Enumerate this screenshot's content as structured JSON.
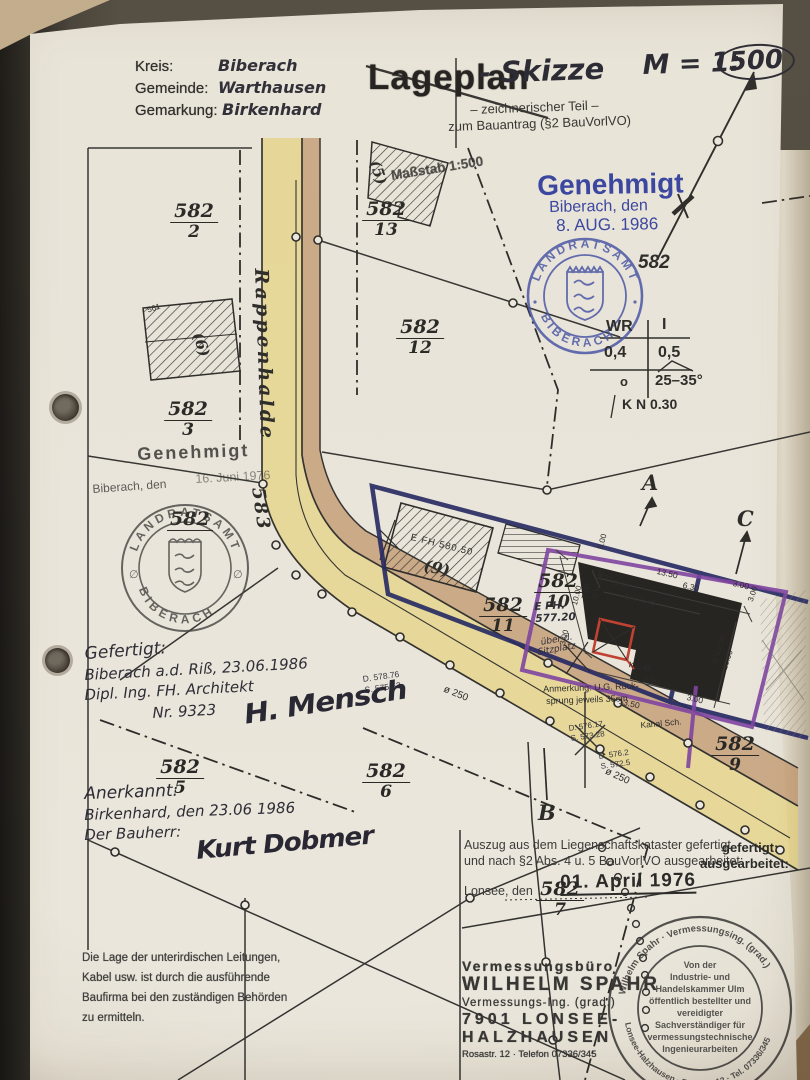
{
  "header": {
    "kreis_label": "Kreis:",
    "kreis": "Biberach",
    "gemeinde_label": "Gemeinde:",
    "gemeinde": "Warthausen",
    "gemarkung_label": "Gemarkung:",
    "gemarkung": "Birkenhard"
  },
  "title": {
    "stamp": "Lageplan",
    "hand": "- Skizze",
    "scale_prefix": "M = 1:",
    "scale_circled": "500",
    "sub1": "– zeichnerischer Teil –",
    "sub2": "zum Bauantrag (§2 BauVorlVO)"
  },
  "approval_1986": {
    "l1": "Genehmigt",
    "l2": "Biberach, den",
    "l3": "8. AUG. 1986",
    "parcel": "582"
  },
  "stamp_blue": {
    "top": "LANDRATSAMT",
    "bottom": "BIBERACH"
  },
  "zoning": {
    "c1": "WR",
    "c2": "I",
    "v1": "0,4",
    "v2": "0,5",
    "v3": "o",
    "v4": "25–35°",
    "kn": "K N 0.30"
  },
  "approval_1976": {
    "l1": "Genehmigt",
    "l2a": "Biberach, den",
    "l2b": "16. Juni 1976"
  },
  "stamp_black": {
    "top": "LANDRATSAMT",
    "bottom": "BIBERACH",
    "l": "∅",
    "r": "∅",
    "parcel": "582"
  },
  "parcels": {
    "p2": {
      "n": "582",
      "d": "2"
    },
    "p3": {
      "n": "582",
      "d": "3"
    },
    "p13": {
      "n": "582",
      "d": "13"
    },
    "p12": {
      "n": "582",
      "d": "12"
    },
    "p11": {
      "n": "582",
      "d": "11"
    },
    "p10": {
      "n": "582",
      "d": "10"
    },
    "p6": {
      "n": "582",
      "d": "6"
    },
    "p5": {
      "n": "582",
      "d": "5"
    },
    "p9": {
      "n": "582",
      "d": "9"
    },
    "p7": {
      "n": "582",
      "d": "7"
    }
  },
  "streets": {
    "name": "Rappenhalde",
    "number": "583"
  },
  "buildings": {
    "b5": "(5)",
    "b6": "(6)",
    "b9": "(9)",
    "n561": "561",
    "massstab": "Maßstab 1:500",
    "efh9": "E FH 580.50",
    "efh_new1": "E FH.",
    "efh_new2": "577.20",
    "sitz1": "über d.",
    "sitz2": "Sitzplatz"
  },
  "sections": {
    "a": "A",
    "b": "B",
    "c": "C"
  },
  "dims": {
    "t1": "1.77",
    "t2": "3.43",
    "t3": "13.50",
    "t4": "6.30",
    "t5": "3.00",
    "t6": "D V 0.45",
    "l1": "5.00",
    "l2": "10.00",
    "l3": "7.00",
    "l4": "D V 0.30",
    "l5": "3.00",
    "r1": "D V 0.30",
    "r2": "10.00",
    "r3": "3.00",
    "b1": "K 0.45",
    "b2": "9.90",
    "b3": "13.50",
    "b4": "3.00"
  },
  "levels": {
    "e1": "D. 578.76",
    "e2": "S. 575.53",
    "e3": "D. 576.17",
    "e4": "S. 573.28",
    "e5": "D. 576.2",
    "e6": "S. 572.5",
    "pipe1": "ø 250",
    "pipe2": "ø 250",
    "kanal": "Kanal Sch."
  },
  "notes": {
    "anm1": "Anmerkung: U.G. Rück-",
    "anm2": "sprung jeweils 35cm"
  },
  "gefertigt": {
    "l1": "Gefertigt:",
    "l2": "Biberach a.d. Riß, 23.06.1986",
    "l3": "Dipl. Ing. FH. Architekt",
    "l4": "Nr. 9323",
    "sig": "H. Mensch"
  },
  "anerkannt": {
    "l1": "Anerkannt:",
    "l2": "Birkenhard, den 23.06 1986",
    "l3": "Der Bauherr:",
    "sig": "Kurt Dobmer"
  },
  "auszug": {
    "l1": "Auszug aus dem Liegenschaftskataster gefertigt",
    "l2": "und nach §2 Abs. 4 u. 5 BauVorlVO ausgearbeitet:",
    "l3": "Lonsee, den",
    "date": "01. April 1976",
    "bold1": "gefertigt:",
    "bold2": "ausgearbeitet:"
  },
  "disclaimer": {
    "l1": "Die Lage der unterirdischen Leitungen,",
    "l2": "Kabel usw. ist durch die ausführende",
    "l3": "Baufirma bei den zuständigen Behörden",
    "l4": "zu ermitteln."
  },
  "surveyor": {
    "l1": "Vermessungsbüro",
    "l2": "WILHELM SPAHR",
    "l3": "Vermessungs-Ing. (grad.)",
    "l4": "7901 LONSEE-",
    "l5": "HALZHAUSEN",
    "l6": "Rosastr. 12 · Telefon 07336/345"
  },
  "stamp_round": {
    "ring_top": "Wilhelm Spahr · Vermessungsing. (grad.)",
    "ring_bottom": "Lonsee-Halzhausen · Rosastr. 12 · Tel. 07336/345",
    "c1": "Von der",
    "c2": "Industrie- und",
    "c3": "Handelskammer Ulm",
    "c4": "öffentlich bestellter und",
    "c5": "vereidigter",
    "c6": "Sachverständiger für",
    "c7": "vermessungstechnische",
    "c8": "Ingenieurarbeiten"
  },
  "colors": {
    "approval_blue": "#2e3da2",
    "navy": "#1b2160",
    "purple": "#7a3da2",
    "red": "#c0392b",
    "street_yellow": "#e8d36f",
    "street_brown": "#bd8f62"
  }
}
